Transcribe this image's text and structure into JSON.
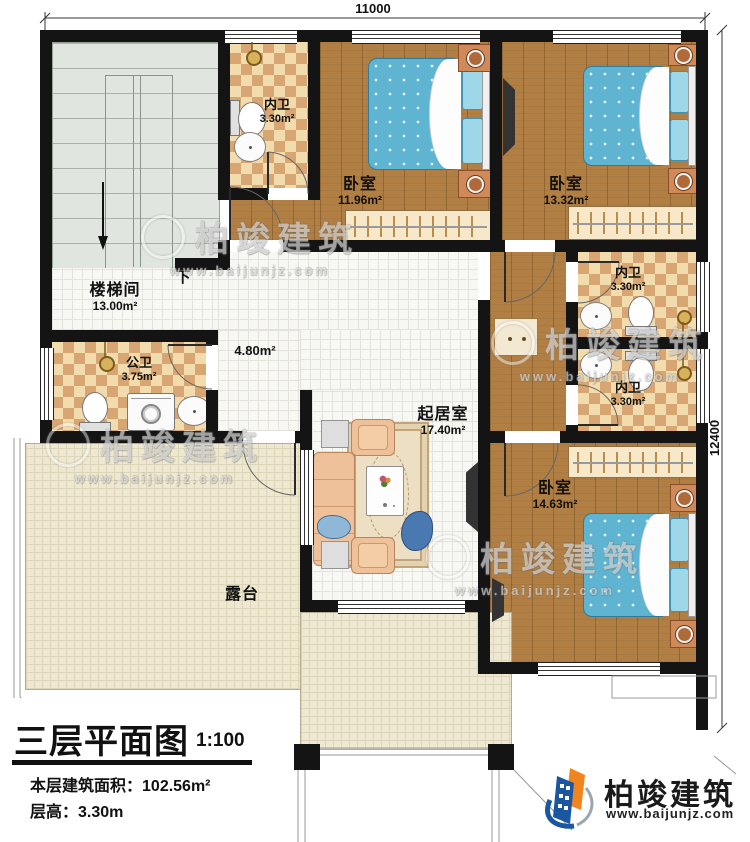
{
  "dimensions": {
    "top": "11000",
    "right": "12400"
  },
  "rooms": {
    "staircase": {
      "name": "楼梯间",
      "area": "13.00m²",
      "down_label": "下"
    },
    "bath_top": {
      "name": "内卫",
      "area": "3.30m²"
    },
    "bedroom1": {
      "name": "卧室",
      "area": "11.96m²"
    },
    "bedroom2": {
      "name": "卧室",
      "area": "13.32m²"
    },
    "bath_mid1": {
      "name": "内卫",
      "area": "3.30m²"
    },
    "bath_mid2": {
      "name": "内卫",
      "area": "3.30m²"
    },
    "bedroom3": {
      "name": "卧室",
      "area": "14.63m²"
    },
    "public_bath": {
      "name": "公卫",
      "area": "3.75m²"
    },
    "hallway": {
      "area": "4.80m²"
    },
    "living": {
      "name": "起居室",
      "area": "17.40m²"
    },
    "terrace": {
      "name": "露台"
    }
  },
  "title_block": {
    "title": "三层平面图",
    "scale": "1:100",
    "area_label": "本层建筑面积：",
    "area_value": "102.56m²",
    "height_label": "层高：",
    "height_value": "3.30m"
  },
  "brand": {
    "name": "柏竣建筑",
    "url": "www.baijunjz.com"
  },
  "watermark": {
    "name": "柏竣建筑",
    "url": "www.baijunjz.com"
  },
  "colors": {
    "wall": "#141414",
    "wood": "#b17f44",
    "checker_dark": "#d8a672",
    "checker_light": "#f2dcad",
    "bed": "#5fb4d2",
    "stairs": "#e0e6df",
    "terrace": "#eee8d2",
    "brand_blue": "#1a57a0",
    "brand_orange": "#f0841e"
  }
}
